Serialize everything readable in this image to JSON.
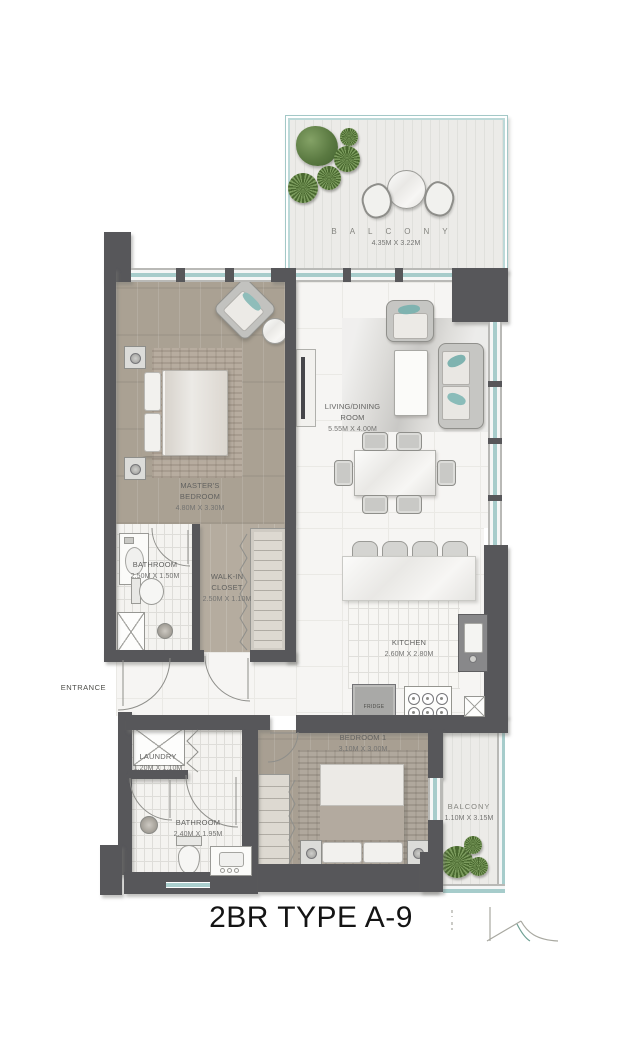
{
  "title": "2BR TYPE A-9",
  "entrance_label": "ENTRANCE",
  "rooms": {
    "balcony_top": {
      "name": "BALCONY",
      "dims": "4.35M X 3.22M"
    },
    "living_dining": {
      "line1": "LIVING/DINING",
      "line2": "ROOM",
      "dims": "5.55M X 4.00M"
    },
    "masters_bedroom": {
      "line1": "MASTER'S",
      "line2": "BEDROOM",
      "dims": "4.80M X 3.30M"
    },
    "bathroom_1": {
      "name": "BATHROOM",
      "dims": "2.50M X 1.50M"
    },
    "walkin_closet": {
      "line1": "WALK-IN",
      "line2": "CLOSET",
      "dims": "2.50M X 1.10M"
    },
    "kitchen": {
      "name": "KITCHEN",
      "dims": "2.60M X 2.80M"
    },
    "laundry": {
      "name": "LAUNDRY",
      "dims": "1.20M X 1.10M"
    },
    "bathroom_2": {
      "name": "BATHROOM",
      "dims": "2.40M X 1.95M"
    },
    "bedroom_1": {
      "name": "BEDROOM 1",
      "dims": "3.10M X 3.00M"
    },
    "balcony_bottom": {
      "name": "BALCONY",
      "dims": "1.10M X 3.15M"
    }
  },
  "appliances": {
    "fridge_label": "FRIDGE"
  },
  "colors": {
    "wall": "#57575a",
    "glass": "#a6cccb",
    "wood_floor": "#aaa193",
    "marble_floor": "#f6f5f3",
    "greenery": "#5b7a42",
    "accent_teal": "#7fb3b0",
    "title_text": "#141414",
    "label_text": "#626260"
  }
}
